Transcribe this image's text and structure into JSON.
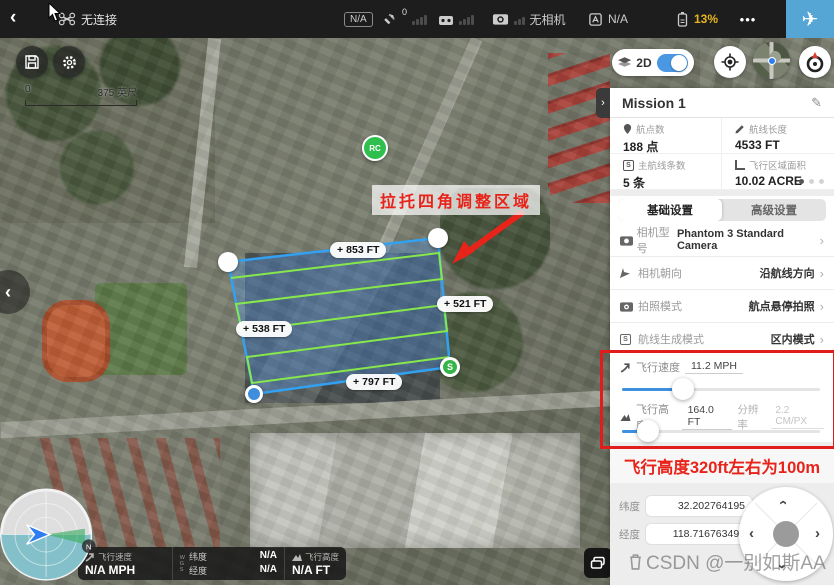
{
  "topbar": {
    "device_status": "无连接",
    "mode_badge": "N/A",
    "gps_count": "0",
    "camera_status": "无相机",
    "status_list": "N/A",
    "battery": "13%",
    "more": "•••"
  },
  "map": {
    "scale_min": "0",
    "scale_max": "375 英尺",
    "annotation": "拉托四角调整区域",
    "edge_labels": {
      "top": "853 FT",
      "right": "521 FT",
      "left": "538 FT",
      "bottom": "797 FT"
    },
    "rc_marker": "RC",
    "start_marker": "S",
    "north_badge": "N"
  },
  "telemetry": {
    "speed_label": "飞行速度",
    "speed_value": "N/A MPH",
    "lat_label": "纬度",
    "lat_value": "N/A",
    "lon_label": "经度",
    "lon_value": "N/A",
    "alt_label": "飞行高度",
    "alt_value": "N/A FT"
  },
  "panel": {
    "toggle_2d": "2D",
    "mission_title": "Mission 1",
    "stats": [
      {
        "label": "航点数",
        "value": "188 点"
      },
      {
        "label": "航线长度",
        "value": "4533 FT"
      },
      {
        "label": "主航线条数",
        "value": "5 条"
      },
      {
        "label": "飞行区域面积",
        "value": "10.02 ACRE"
      }
    ],
    "tabs": [
      "基础设置",
      "高级设置"
    ],
    "settings": [
      {
        "label": "相机型号",
        "value": "Phantom 3 Standard Camera"
      },
      {
        "label": "相机朝向",
        "value": "沿航线方向"
      },
      {
        "label": "拍照模式",
        "value": "航点悬停拍照"
      },
      {
        "label": "航线生成模式",
        "value": "区内模式"
      }
    ],
    "speed_slider": {
      "label": "飞行速度",
      "value": "11.2 MPH"
    },
    "alt_slider": {
      "label": "飞行高度",
      "value": "164.0 FT",
      "res_label": "分辨率",
      "res_value": "2.2 CM/PX"
    },
    "note": "飞行高度320ft左右为100m",
    "coords": [
      {
        "label": "纬度",
        "value": "32.202764195"
      },
      {
        "label": "经度",
        "value": "118.716763493"
      }
    ]
  },
  "watermark": "CSDN @一别如斯AA",
  "colors": {
    "accent_blue": "#55a6d4",
    "toggle_blue": "#4a97e3",
    "slider_blue": "#3d8fe0",
    "polygon_blue": "#33a1f2",
    "route_green": "#86e84c",
    "alert_red": "#e8231a",
    "battery_yellow": "#e8b51e",
    "marker_green": "#2fbf4f"
  }
}
